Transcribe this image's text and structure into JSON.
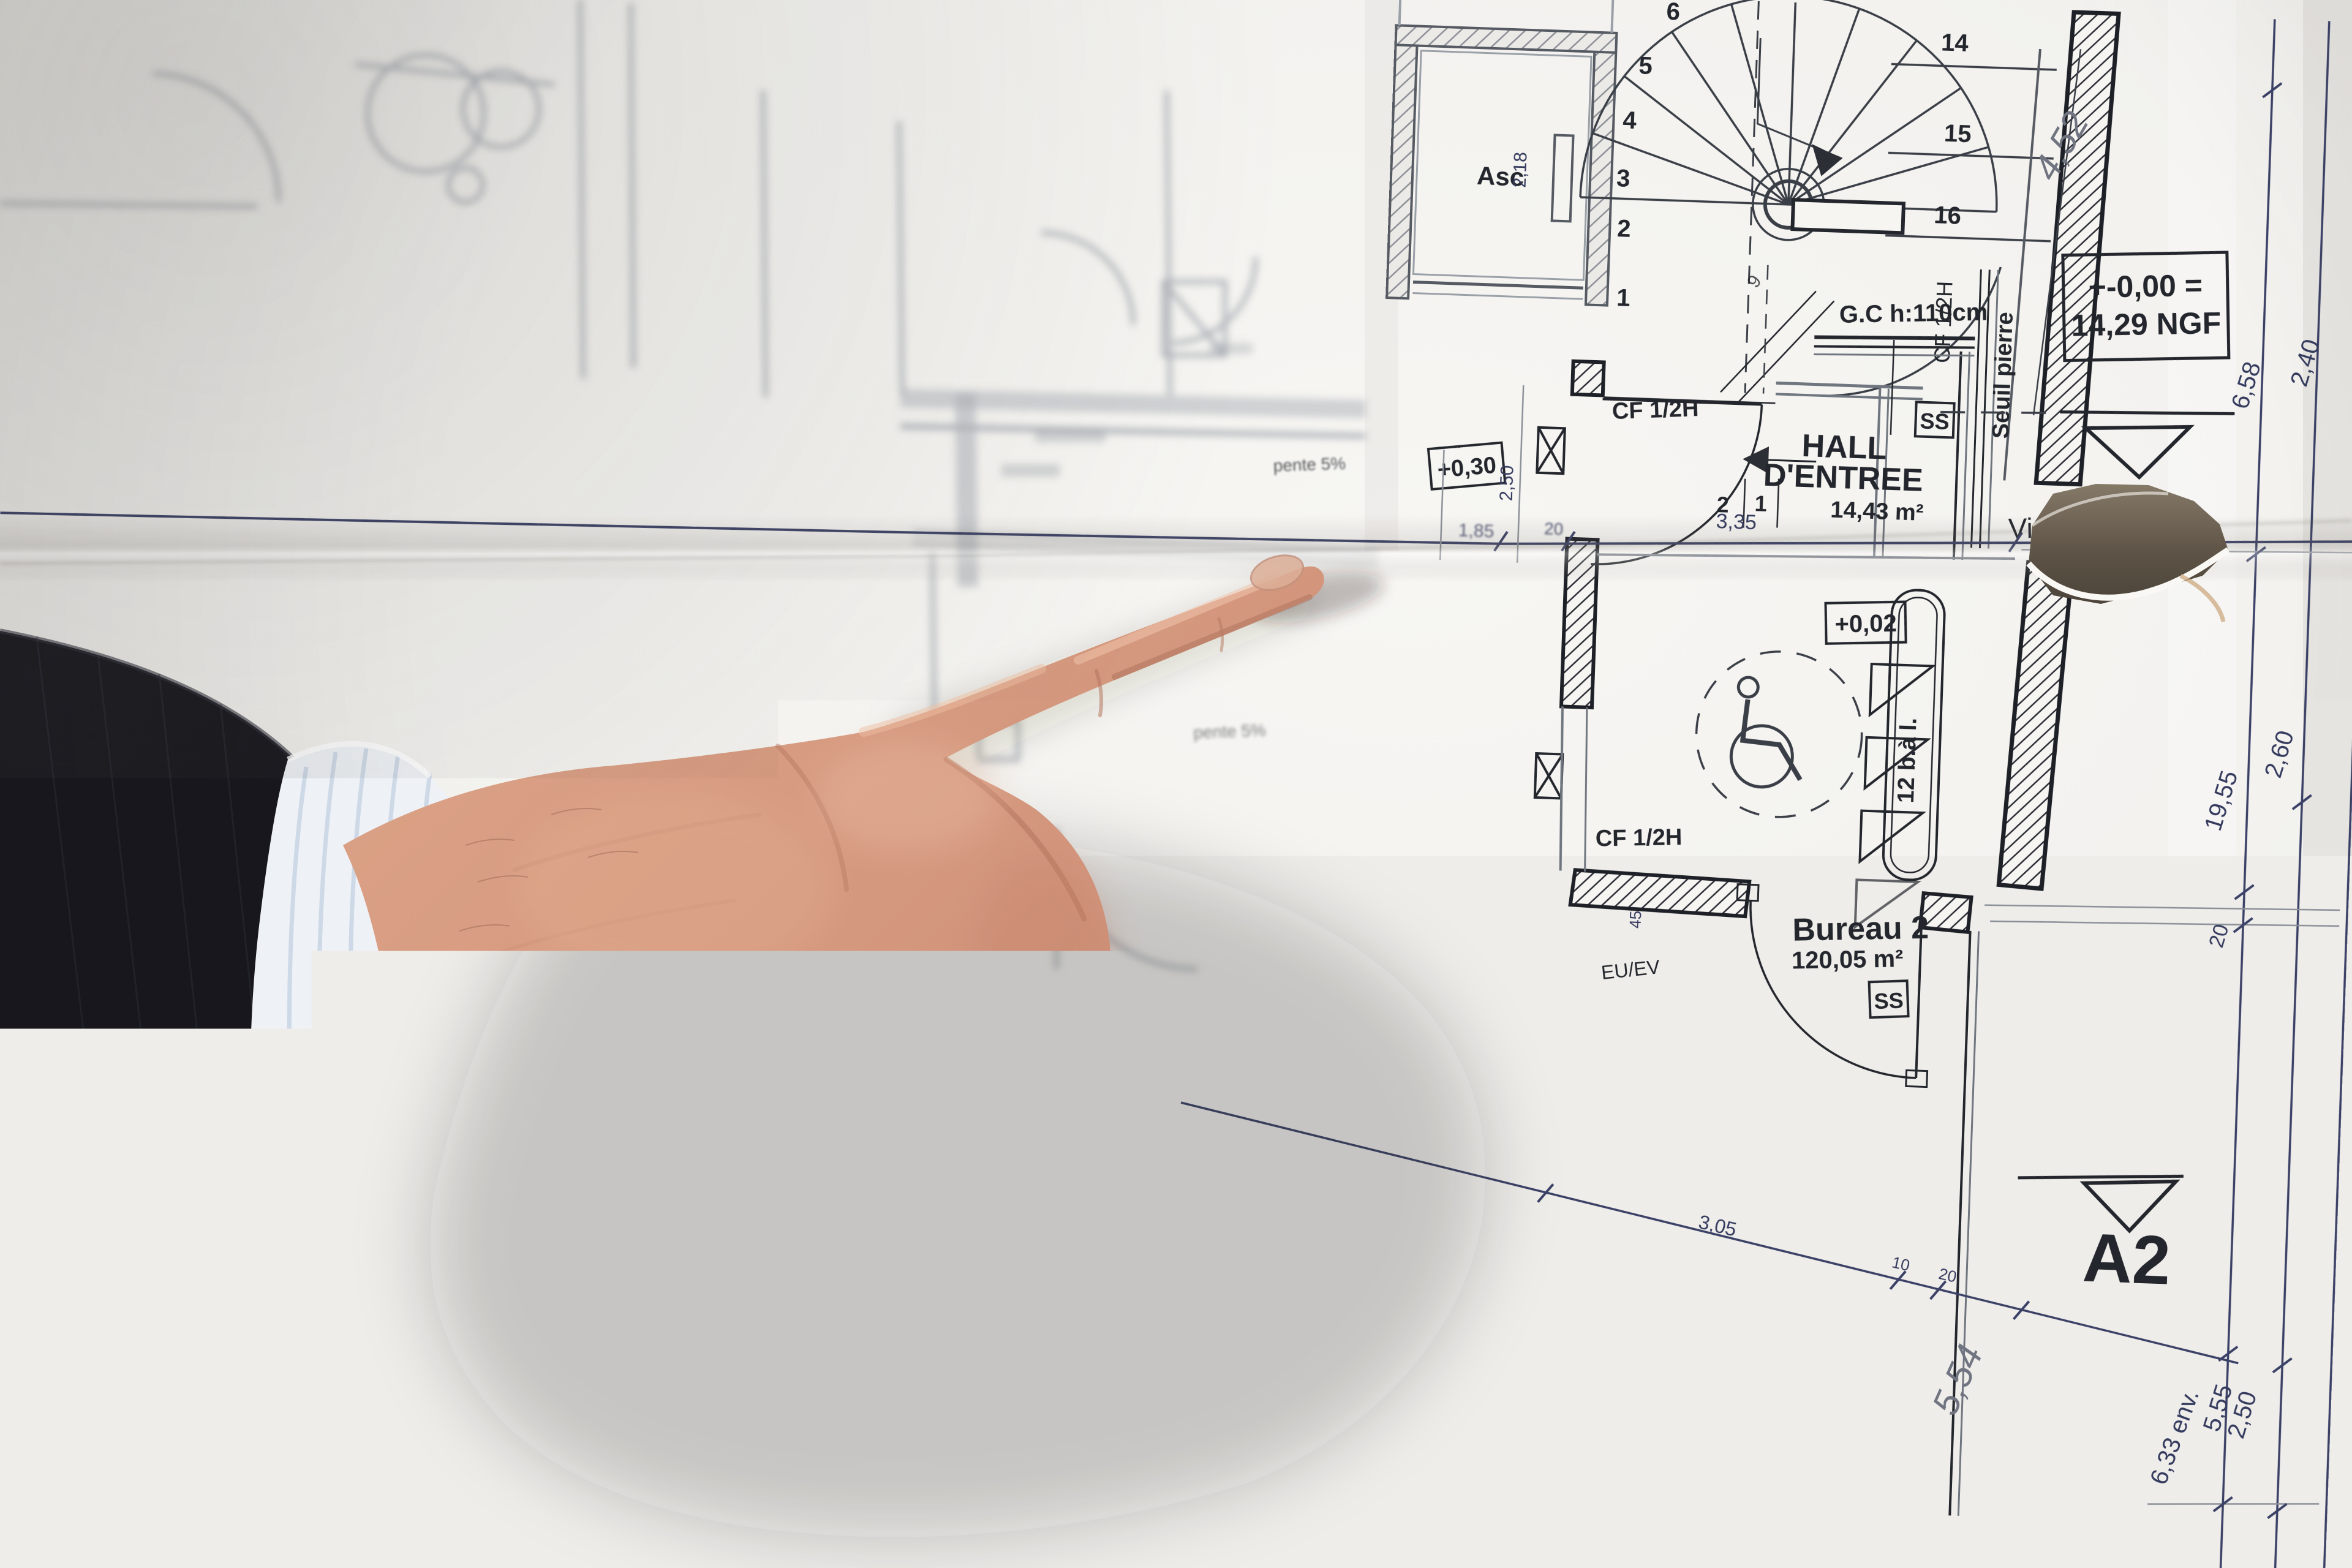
{
  "colors": {
    "paper": "#f3f2ef",
    "ink_line": "#23262c",
    "dim_line_blue": "#3b4166",
    "blurred_line": "#b0b4ba",
    "pencil": "#6f7480",
    "skin": "#d49a82",
    "skin_shadow": "#b97e69",
    "skin_highlight": "#ecc0a8",
    "sleeve": "#17171d",
    "cuff": "#eef1f6",
    "cuff_stripe": "#c9d5e5",
    "tear_shadow": "#6a5f50"
  },
  "plan": {
    "rooms": {
      "hall": {
        "name": "HALL",
        "name2": "D'ENTREE",
        "area": "14,43 m²"
      },
      "bureau2": {
        "name": "Bureau 2",
        "area": "120,05 m²"
      },
      "elevator": {
        "label": "Asc",
        "dim": "2,18"
      }
    },
    "levels": {
      "datum_line1": "+-0,00 =",
      "datum_line2": "14,29 NGF",
      "v030": "+0,30",
      "v002": "+0,02",
      "v017": "+0,17",
      "v006": "+ 0,06"
    },
    "sections": {
      "a1": "A1",
      "a2": "A2"
    },
    "annotations": {
      "visioph": "Visioph.",
      "guard": "G.C h:110cm",
      "seuil": "Seuil pierre",
      "cf": "CF 1/2H",
      "mailboxes": "12 b.à l.",
      "ss": "SS",
      "euev": "EU/EV",
      "ev": "EV",
      "pente": "pente 5%"
    },
    "stairs": {
      "left_steps": [
        "6",
        "5",
        "4",
        "3",
        "2",
        "1"
      ],
      "right_steps": [
        "14",
        "15",
        "16"
      ],
      "hall_steps": [
        "2",
        "1"
      ],
      "lower_step": "9"
    },
    "dims": {
      "d335": "3,35",
      "d185": "1,85",
      "d20": "20",
      "d250v": "2,50",
      "d305": "3,05",
      "d10": "10",
      "d20b": "20",
      "d45": "45",
      "r658": "6,58",
      "r240": "2,40",
      "r1955": "19,55",
      "r260": "2,60",
      "r20": "20",
      "r555": "5,55",
      "r250": "2,50",
      "r633": "6,33 env."
    },
    "handwritten": {
      "top": "4,52",
      "bottom": "5,54"
    }
  }
}
